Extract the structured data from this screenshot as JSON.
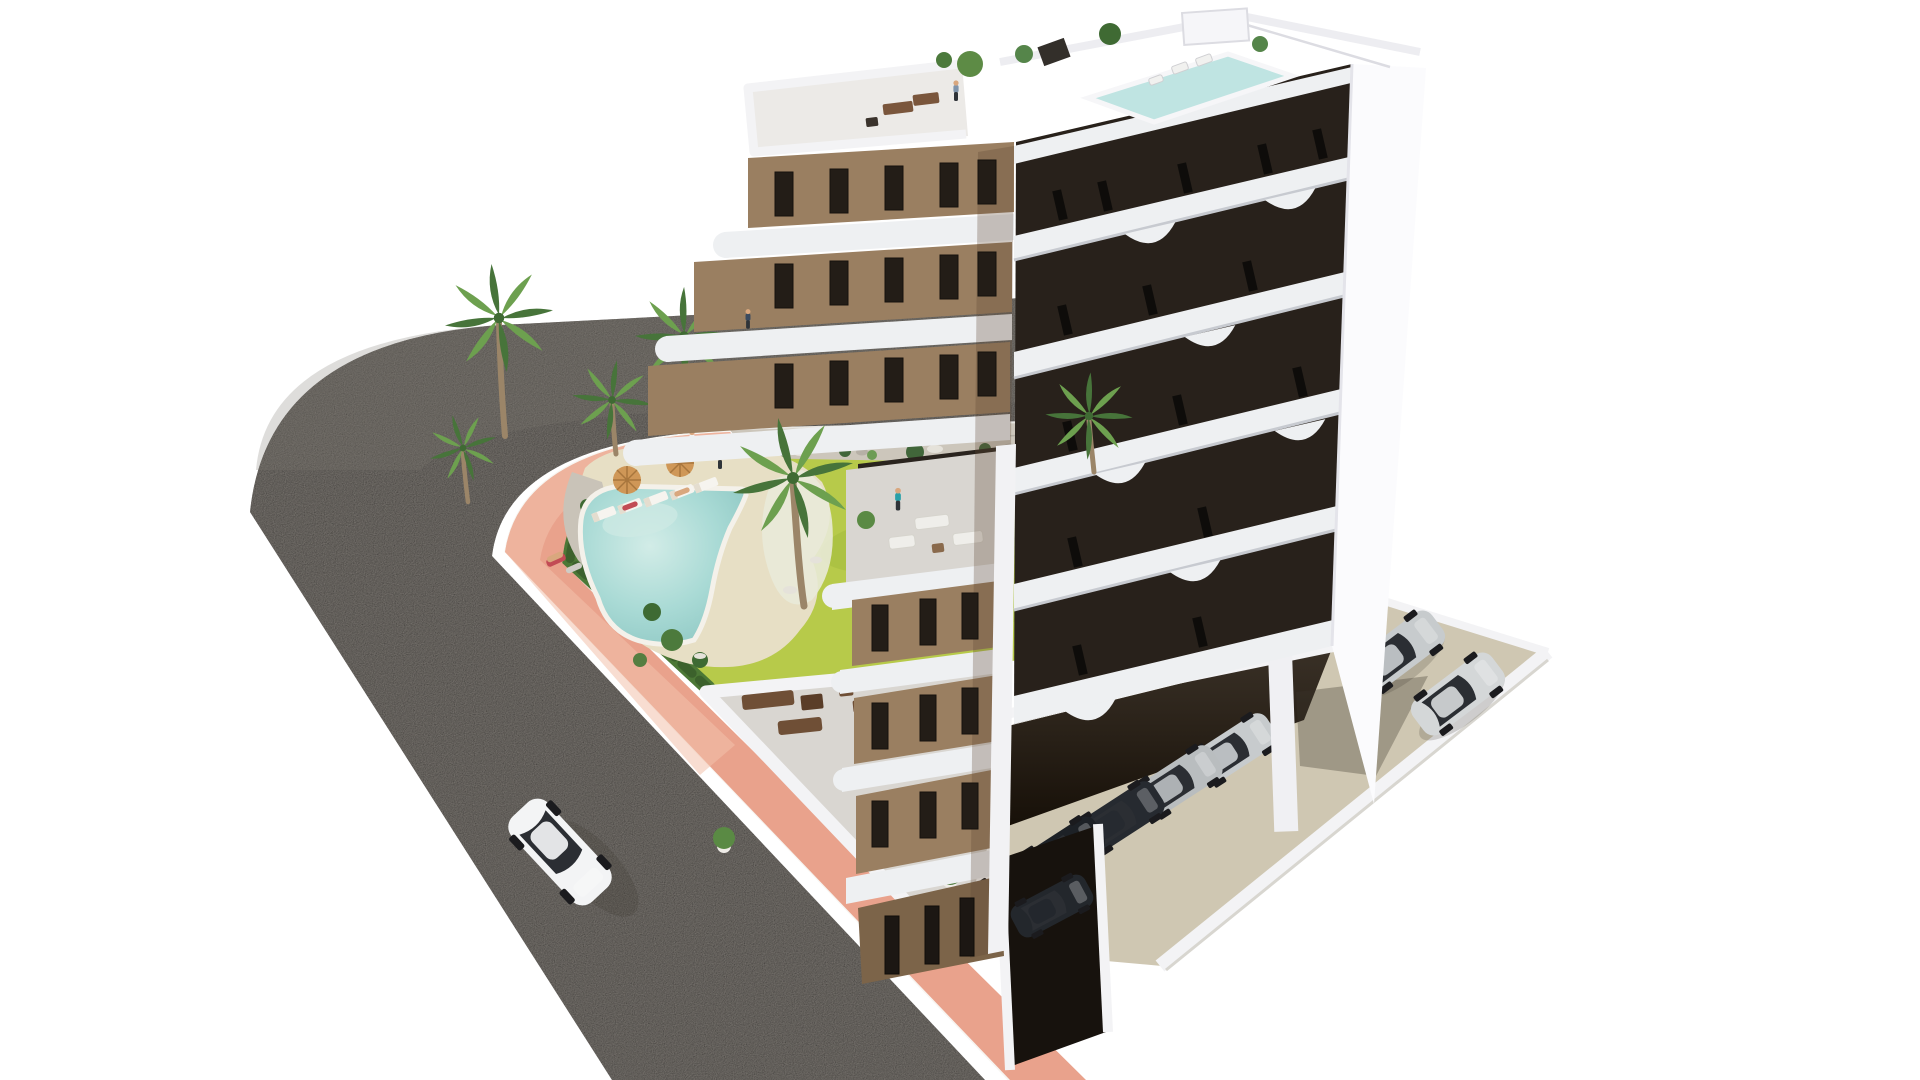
{
  "colors": {
    "background": "#ffffff",
    "road": "#8b8680",
    "road_shade": "#7d7871",
    "sidewalk": "#e9a28c",
    "sidewalk_light": "#f3c1ab",
    "curb": "#f7f5f1",
    "gravel": "#ccc6bb",
    "rock_light": "#e5e2da",
    "grass": "#b7ca4a",
    "grass_dark": "#9fb83c",
    "grass_light": "#c8d85e",
    "hedge": "#4c7836",
    "hedge_dark": "#3c612c",
    "pool_deck": "#e7dfc5",
    "pool_water": "#9ed3cf",
    "pool_light": "#cfe9e4",
    "palm_trunk": "#9b8568",
    "palm_dark": "#47743a",
    "palm_light": "#6da04f",
    "facade_brown": "#9a7f61",
    "facade_brown_dark": "#7c6449",
    "facade_dark": "#28211b",
    "band_white": "#eef0f2",
    "band_shadow": "#c7cad0",
    "white_bright": "#fbfbfd",
    "white_soft": "#f3f3f5",
    "corner_white": "#f2f2f4",
    "terrace_floor": "#d9d6d1",
    "window_dark": "#231d17",
    "slit_dark": "#0e0c0a",
    "concrete_pad": "#cfc7b2",
    "parking_shadow": "#241c14",
    "rooftop_pool": "#bfe4e2",
    "car_white": "#f3f4f5",
    "car_silver": "#c7cbcd",
    "car_silver2": "#b9bdbf",
    "car_dark": "#262a30",
    "car_glass": "#2b2e33",
    "furniture_brown": "#6f4f36",
    "furniture_dark": "#5a3d28",
    "umbrella": "#cf9757",
    "person_teal": "#2aa0a8",
    "person_blue": "#7f94ab",
    "person_navy": "#3a4a5f",
    "person_white": "#f2f2f2",
    "skin": "#d9a77e",
    "towel_red": "#c24b55"
  },
  "scene": {
    "setting": {
      "type": "aerial-architectural-render",
      "background": "white"
    },
    "building": {
      "label": "modern-apartment-block",
      "floors_visible": 8,
      "left_facade": "brown-with-white-balcony-bands",
      "right_facade": "dark-brown-with-white-curved-balcony-bands",
      "rooftop": {
        "pools": 1,
        "planters": 4,
        "terraces": 2
      }
    },
    "garden": {
      "pool_shape": "freeform-kidney",
      "palm_trees": 6,
      "sun_loungers": 5,
      "umbrellas": 2,
      "hedge_border": true,
      "lawn": true
    },
    "road": {
      "surface": "asphalt",
      "curved": true,
      "sidewalk": "salmon-pink"
    },
    "vehicles": {
      "moving_white_car": 1,
      "parked_under_building": 5,
      "parked_on_pad": 2,
      "garage_car": 1
    },
    "people_count": 7
  }
}
